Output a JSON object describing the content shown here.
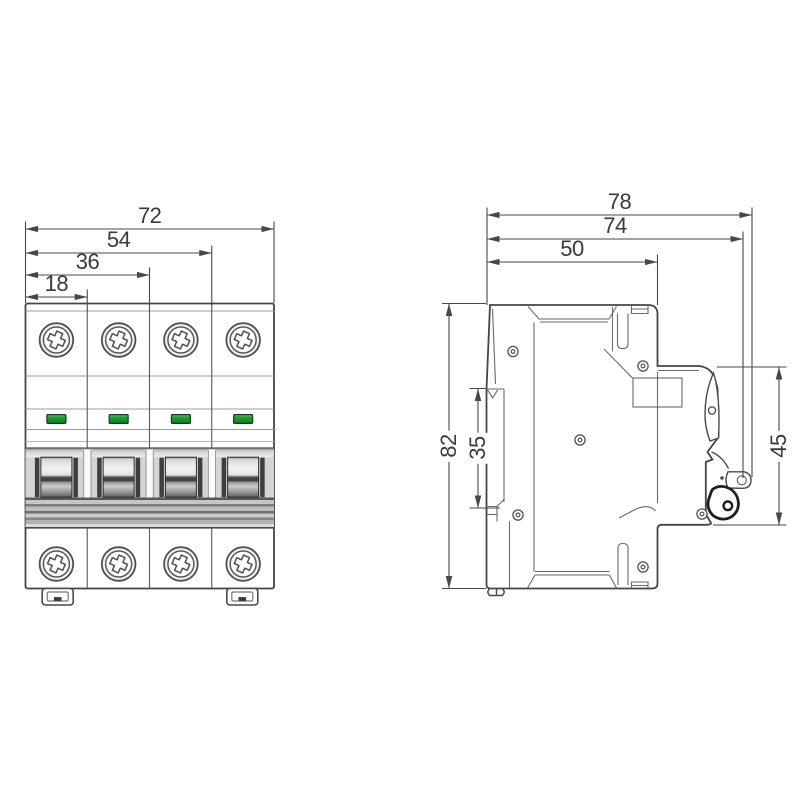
{
  "front_view": {
    "pole_count": 4,
    "dimensions": {
      "width_total": "72",
      "width_three_modules": "54",
      "width_two_modules": "36",
      "width_one_module": "18"
    }
  },
  "side_view": {
    "dimensions": {
      "depth_total": "78",
      "depth_to_handle": "74",
      "depth_front_section": "50",
      "height_total": "82",
      "din_rail_section": "35",
      "front_protrusion_height": "45"
    }
  },
  "colors": {
    "line": "#4a4a4a",
    "indicator_green": "#1ea333",
    "toggle_dark": "#3f3f3f",
    "background": "#ffffff"
  }
}
